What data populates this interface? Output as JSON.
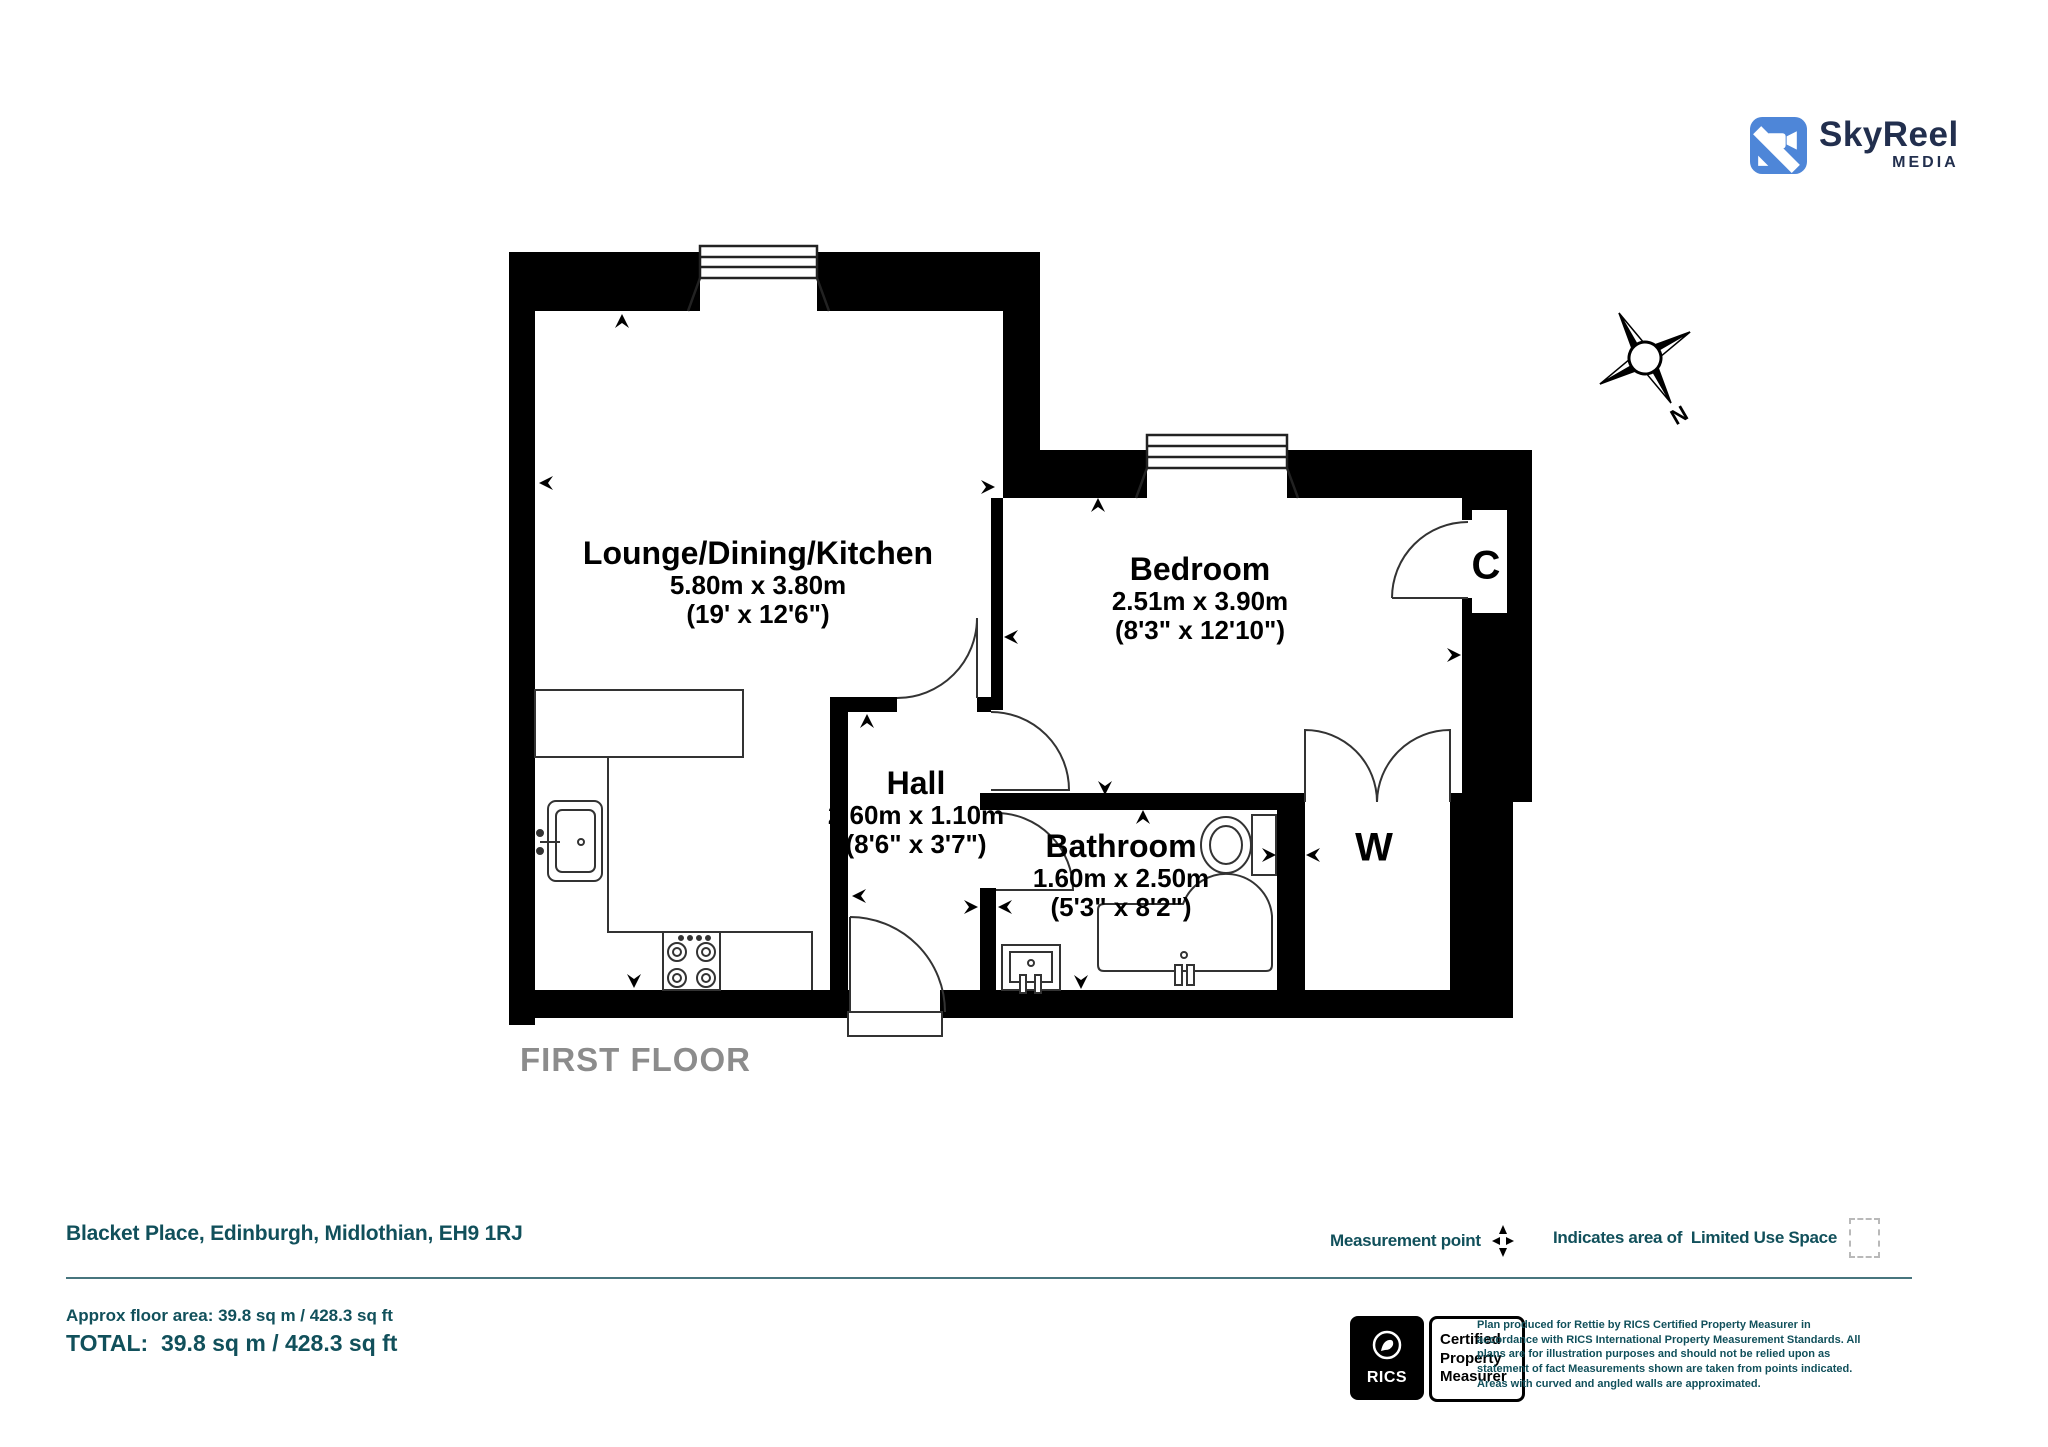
{
  "logo": {
    "name": "SkyReel",
    "sub": "MEDIA"
  },
  "compass": {
    "north": "N"
  },
  "plan": {
    "floor_label": "FIRST FLOOR",
    "rooms": [
      {
        "name": "Lounge/Dining/Kitchen",
        "metric": "5.80m x 3.80m",
        "imperial": "(19' x 12'6\")"
      },
      {
        "name": "Bedroom",
        "metric": "2.51m x 3.90m",
        "imperial": "(8'3\" x 12'10\")"
      },
      {
        "name": "Hall",
        "metric": "2.60m x 1.10m",
        "imperial": "(8'6\" x 3'7\")"
      },
      {
        "name": "Bathroom",
        "metric": "1.60m x 2.50m",
        "imperial": "(5'3\" x 8'2\")"
      }
    ],
    "closets": [
      {
        "label": "C"
      },
      {
        "label": "W"
      }
    ]
  },
  "footer": {
    "address": "Blacket Place, Edinburgh, Midlothian, EH9 1RJ",
    "legend": {
      "measurement_point": "Measurement point",
      "limited_use": "Indicates area of  Limited Use Space"
    },
    "areas": {
      "approx": "Approx floor area: 39.8 sq m / 428.3 sq ft",
      "total": "TOTAL:  39.8 sq m / 428.3 sq ft"
    },
    "rics": {
      "brand": "RICS",
      "certified_lines": [
        "Certified",
        "Property",
        "Measurer"
      ],
      "disclaimer": "Plan produced for Rettie by RICS Certified Property Measurer in accordance with RICS International Property Measurement Standards. All plans are for illustration purposes and should not be relied upon as statement of fact Measurements shown are taken from points indicated. Areas with curved and angled walls are approximated."
    }
  },
  "colors": {
    "teal": "#11505b",
    "wall_black": "#000000",
    "logo_blue": "#4e86d8",
    "logo_navy": "#222f4e",
    "floor_gray": "#8c8c8c"
  }
}
